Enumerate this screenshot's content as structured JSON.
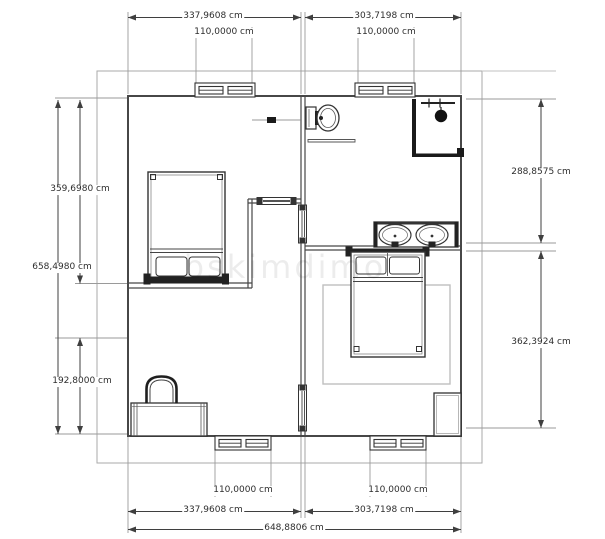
{
  "app": {
    "type": "floor-plan-drawing",
    "unit_label": "cm"
  },
  "watermark": "bskimdimo",
  "dimensions": {
    "top_width_left": "337,9608 cm",
    "top_width_right": "303,7198 cm",
    "top_window_left": "110,0000 cm",
    "top_window_right": "110,0000 cm",
    "left_upper": "359,6980 cm",
    "left_total": "658,4980 cm",
    "left_lower": "192,8000 cm",
    "right_upper": "288,8575 cm",
    "right_lower": "362,3924 cm",
    "bottom_window_left": "110,0000 cm",
    "bottom_window_right": "110,0000 cm",
    "bottom_width_left": "337,9608 cm",
    "bottom_width_right": "303,7198 cm",
    "bottom_total": "648,8806 cm"
  },
  "fixtures": [
    "window",
    "door",
    "toilet",
    "shower",
    "double-sink-vanity",
    "double-bed",
    "rug",
    "nightstand",
    "desk",
    "chair",
    "towel-shelf"
  ],
  "colors": {
    "wall": "#474747",
    "dimension": "#3f3f3f",
    "extension": "#999999",
    "frame": "#aaaaaa",
    "fixture_dark": "#1a1a1a",
    "rug": "#bfbfbf",
    "background": "#ffffff"
  }
}
